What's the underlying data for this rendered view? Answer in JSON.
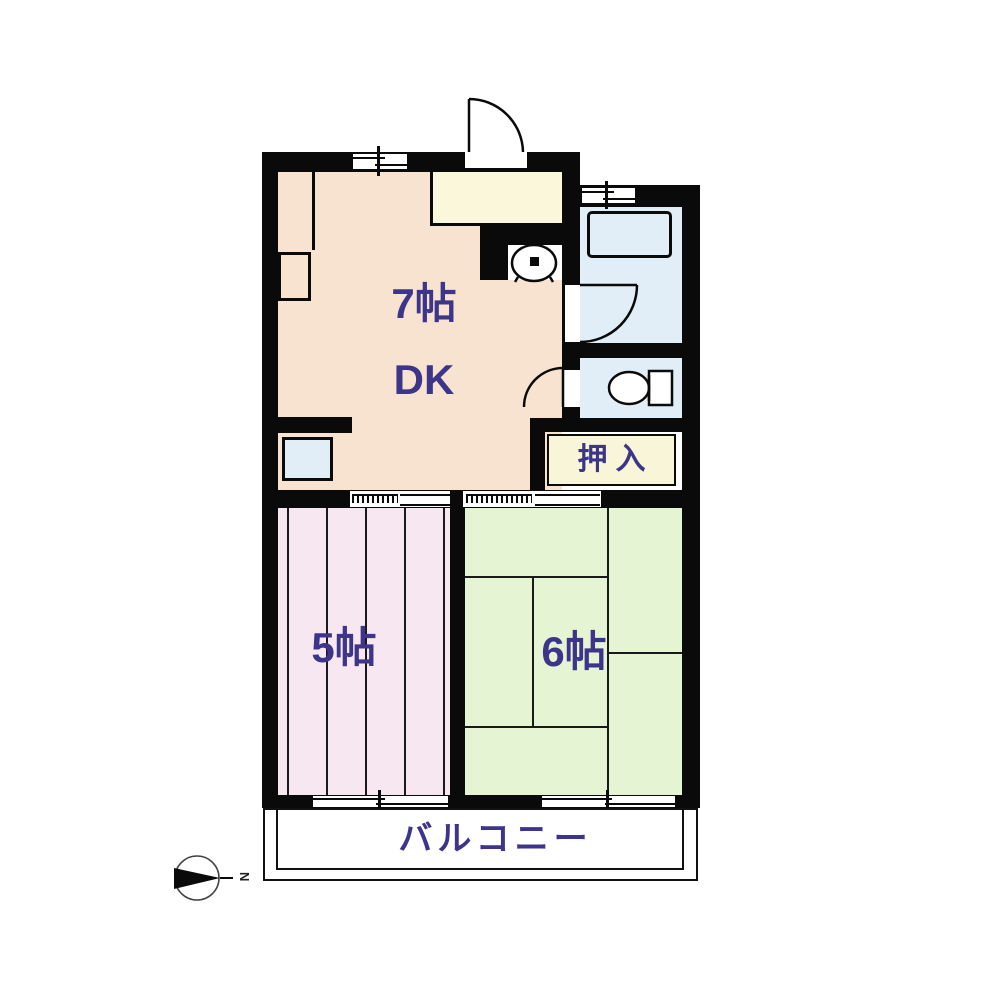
{
  "plan": {
    "rooms": {
      "dk": {
        "size_label": "7帖",
        "type_label": "DK"
      },
      "western_room": {
        "size_label": "5帖"
      },
      "tatami_room": {
        "size_label": "6帖"
      },
      "closet": {
        "label": "押入"
      },
      "balcony": {
        "label": "バルコニー"
      }
    },
    "compass": {
      "north_label": "N"
    },
    "fixtures": [
      "entrance-door",
      "kitchen-counter",
      "washbasin",
      "bathtub",
      "toilet",
      "washing-machine-space",
      "storage-box",
      "sliding-window",
      "sliding-door"
    ],
    "colors": {
      "wall": "#0a0a0a",
      "dk_fill": "#f8e2d0",
      "kitchen_fill": "#fbf7da",
      "closet_fill": "#f9f5d8",
      "western_fill": "#f6e7f0",
      "tatami_fill": "#e5f5d3",
      "bath_fill": "#e1eef7",
      "balcony_fill": "#ffffff",
      "text": "#3d3589"
    }
  }
}
